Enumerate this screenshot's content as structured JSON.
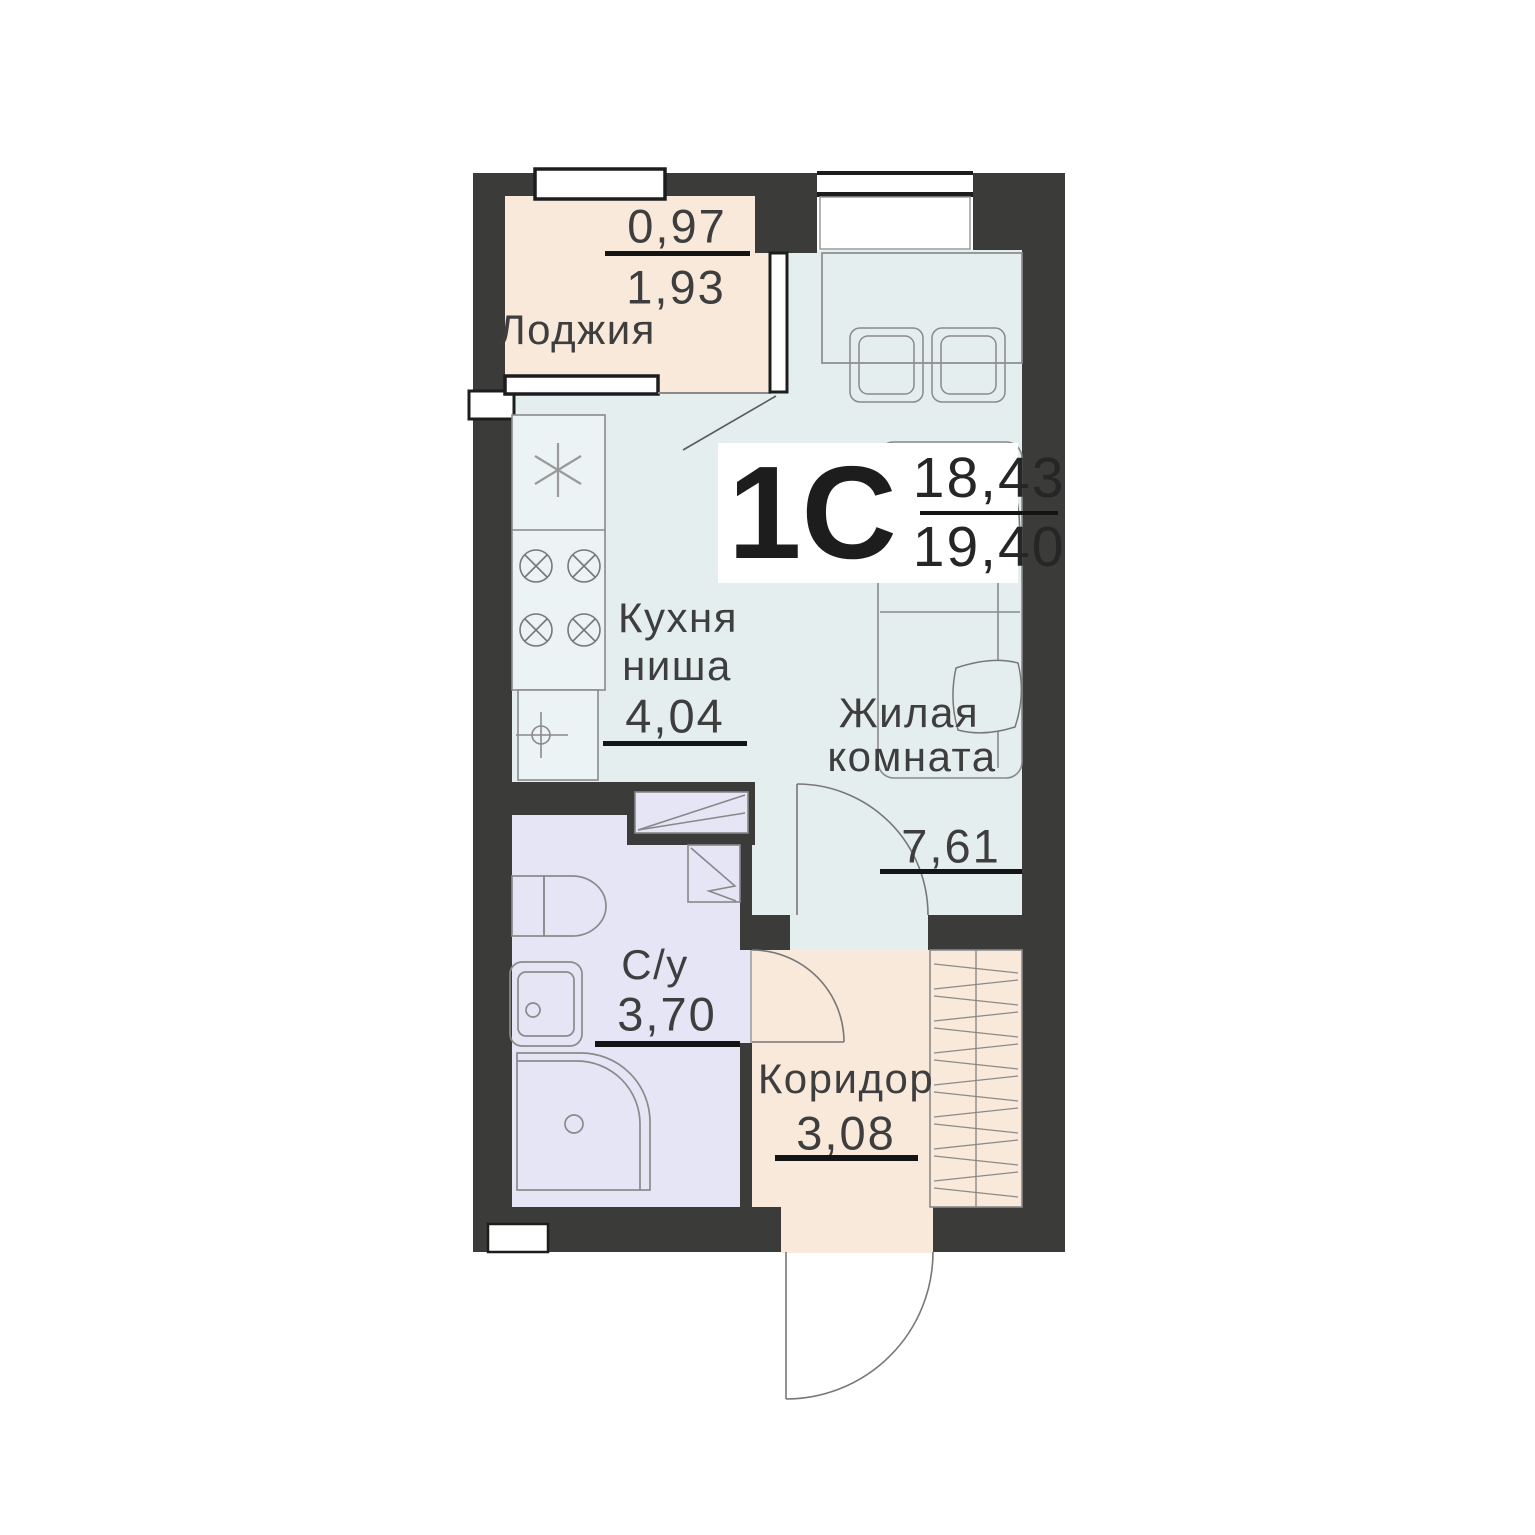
{
  "unit": {
    "type_label": "1С",
    "living_area": "18,43",
    "total_area": "19,40"
  },
  "rooms": {
    "loggia": {
      "name": "Лоджия",
      "area_upper": "0,97",
      "area_lower": "1,93"
    },
    "kitchen": {
      "name_line1": "Кухня",
      "name_line2": "ниша",
      "area": "4,04"
    },
    "living": {
      "name_line1": "Жилая",
      "name_line2": "комната",
      "area": "7,61"
    },
    "bathroom": {
      "name": "С/у",
      "area": "3,70"
    },
    "corridor": {
      "name": "Коридор",
      "area": "3,08"
    }
  },
  "icons": [
    "fridge-icon",
    "stove-icon",
    "kitchen-sink-icon",
    "toilet-icon",
    "washbasin-icon",
    "shower-icon",
    "vent-shaft-icon",
    "wardrobe-icon",
    "door-swing-icon",
    "window-icon",
    "table-icon",
    "chair-icon",
    "bed-icon",
    "pillow-icon"
  ],
  "colors": {
    "wall": "#3b3b39",
    "room_main": "#e5eeef",
    "room_loggia": "#f8e9db",
    "room_bathroom": "#e5e5f6",
    "room_corridor": "#f8e9db",
    "furniture_outline": "#8a8a8a",
    "text": "#3e3e3e",
    "divider": "#141414",
    "window_fill": "#ffffff"
  }
}
